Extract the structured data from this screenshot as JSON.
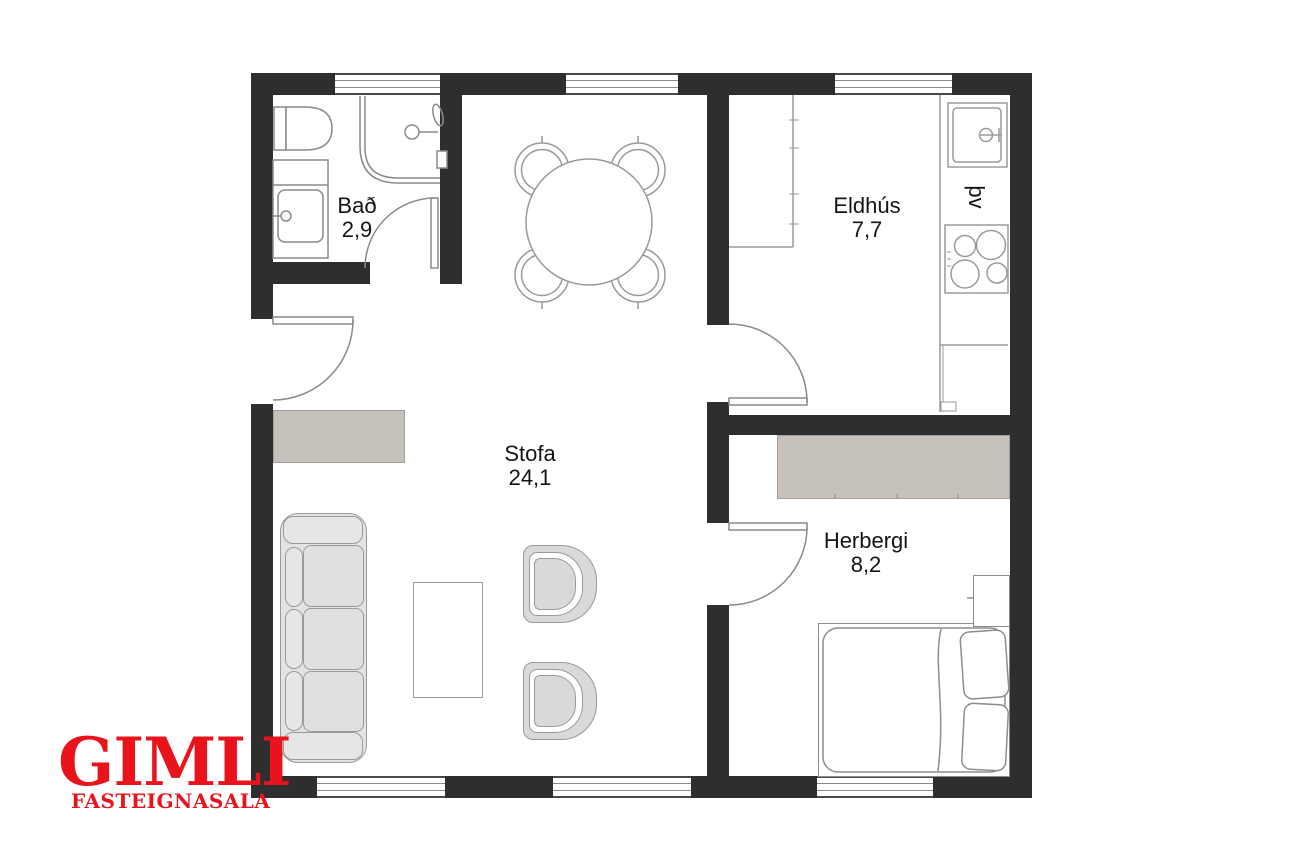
{
  "plan_title": "floor-plan",
  "rooms": [
    {
      "name": "Bað",
      "area": "2,9"
    },
    {
      "name": "Eldhús",
      "area": "7,7"
    },
    {
      "name": "Stofa",
      "area": "24,1"
    },
    {
      "name": "Herbergi",
      "area": "8,2"
    }
  ],
  "labels": {
    "washing_machine": "þv"
  },
  "logo": {
    "name": "GIMLI",
    "tagline": "FASTEIGNASALA",
    "color": "#e8131b"
  },
  "colors": {
    "wall": "#2e2e2e",
    "furniture_outline": "#9a9a9a",
    "soft_furniture_fill": "#e3e3e3",
    "cabinet_fill": "#c7c1bc",
    "background": "#ffffff"
  }
}
